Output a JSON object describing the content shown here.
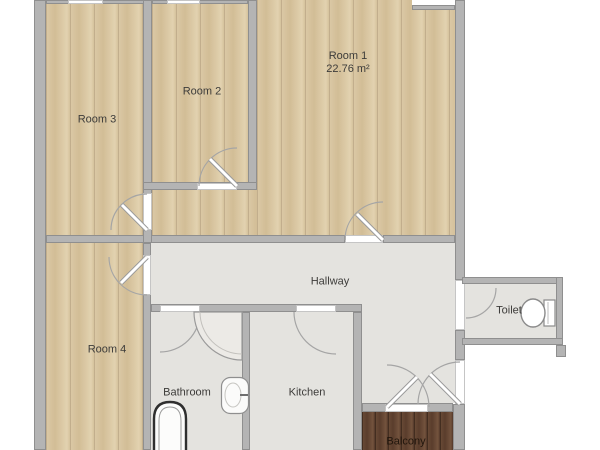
{
  "rooms": {
    "room1": {
      "label": "Room 1",
      "area": "22.76 m²"
    },
    "room2": {
      "label": "Room 2"
    },
    "room3": {
      "label": "Room 3"
    },
    "room4": {
      "label": "Room 4"
    },
    "hallway": {
      "label": "Hallway"
    },
    "toilet": {
      "label": "Toilet"
    },
    "bathroom": {
      "label": "Bathroom"
    },
    "kitchen": {
      "label": "Kitchen"
    },
    "balcony": {
      "label": "Balcony"
    }
  },
  "colors": {
    "wood_floor": "#d9c7a3",
    "gray_floor": "#e4e3df",
    "balcony_wood": "#5e412f",
    "wall": "#b4b4b4",
    "label_text": "#3d3c3a"
  }
}
